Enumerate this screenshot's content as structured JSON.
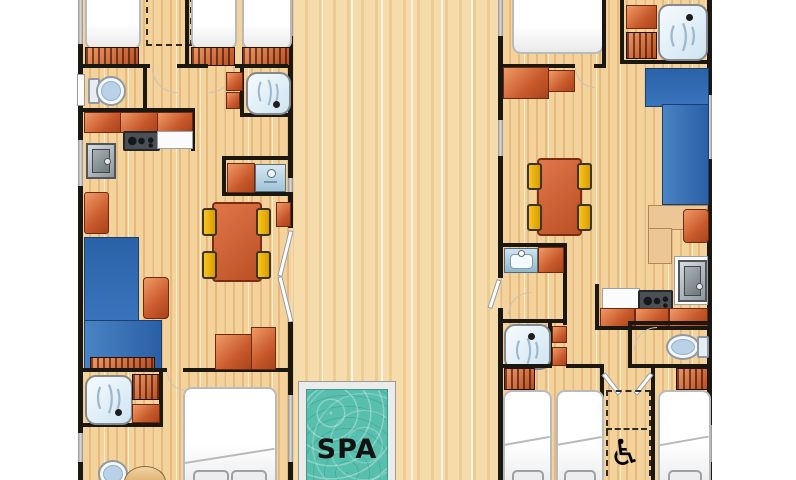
{
  "spa": {
    "label": "SPA"
  },
  "icons": {
    "wheelchair_glyph": "♿",
    "wheelchair_icon": "wheelchair-accessible-icon"
  },
  "colors": {
    "wall": "#1b1713",
    "unit_floor": "#f4d29c",
    "deck_floor": "#f6dcab",
    "furniture_orange": "#d2602f",
    "chair_yellow": "#f1b503",
    "sofa_blue": "#2e6cb0",
    "spa_water_teal": "#58bfae",
    "shower_tray_blue": "#cfe4f1",
    "window_gray": "#a5a5a5",
    "bed_white": "#fefefe"
  }
}
